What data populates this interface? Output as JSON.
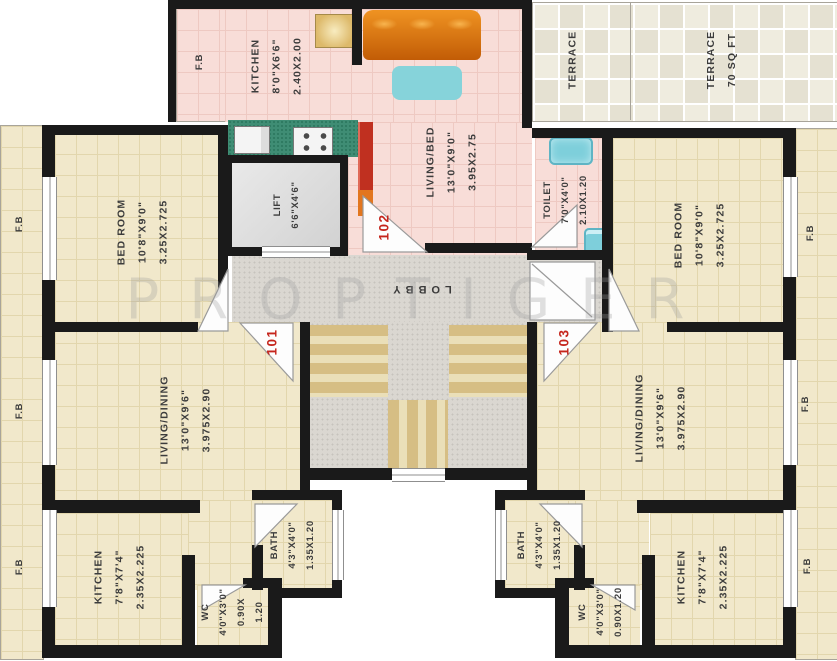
{
  "watermark": {
    "text": "PROPTIGER"
  },
  "units": {
    "left": "101",
    "middle": "102",
    "right": "103"
  },
  "rooms": {
    "fb": "F.B",
    "kitchen_102": [
      "KITCHEN",
      "8'0\"X6'6\"",
      "2.40X2.00"
    ],
    "living_bed": [
      "LIVING/BED",
      "13'0\"X9'0\"",
      "3.95X2.75"
    ],
    "terrace_left": "TERRACE",
    "terrace_right": [
      "TERRACE",
      "70 SQ FT"
    ],
    "toilet": [
      "TOILET",
      "7'0\"X4'0\"",
      "2.10X1.20"
    ],
    "lift": [
      "LIFT",
      "6'6\"X4'6\""
    ],
    "lobby": "LOBBY",
    "bedroom": [
      "BED ROOM",
      "10'8\"X9'0\"",
      "3.25X2.725"
    ],
    "living_dining": [
      "LIVING/DINING",
      "13'0\"X9'6\"",
      "3.975X2.90"
    ],
    "kitchen_small": [
      "KITCHEN",
      "7'8\"X7'4\"",
      "2.35X2.225"
    ],
    "bath": [
      "BATH",
      "4'3\"X4'0\"",
      "1.35X1.20"
    ],
    "wc_split": [
      "WC",
      "4'0\"X3'0\"",
      "0.90X",
      "1.20"
    ],
    "wc": [
      "WC",
      "4'0\"X3'0\"",
      "0.90X1.20"
    ]
  },
  "colors": {
    "floor_cream": "#f1e8cb",
    "floor_pink": "#f8ddd8",
    "wall_black": "#1a1a1a",
    "terrace_tile": "#efecdf",
    "lobby_grey": "#dad7d1",
    "step_tan": "#d6be84",
    "counter_green": "#3f8d74",
    "sofa_orange": "#e8881c",
    "fixture_cyan": "#7ecfdb",
    "unit_number_red": "#c5251c"
  }
}
